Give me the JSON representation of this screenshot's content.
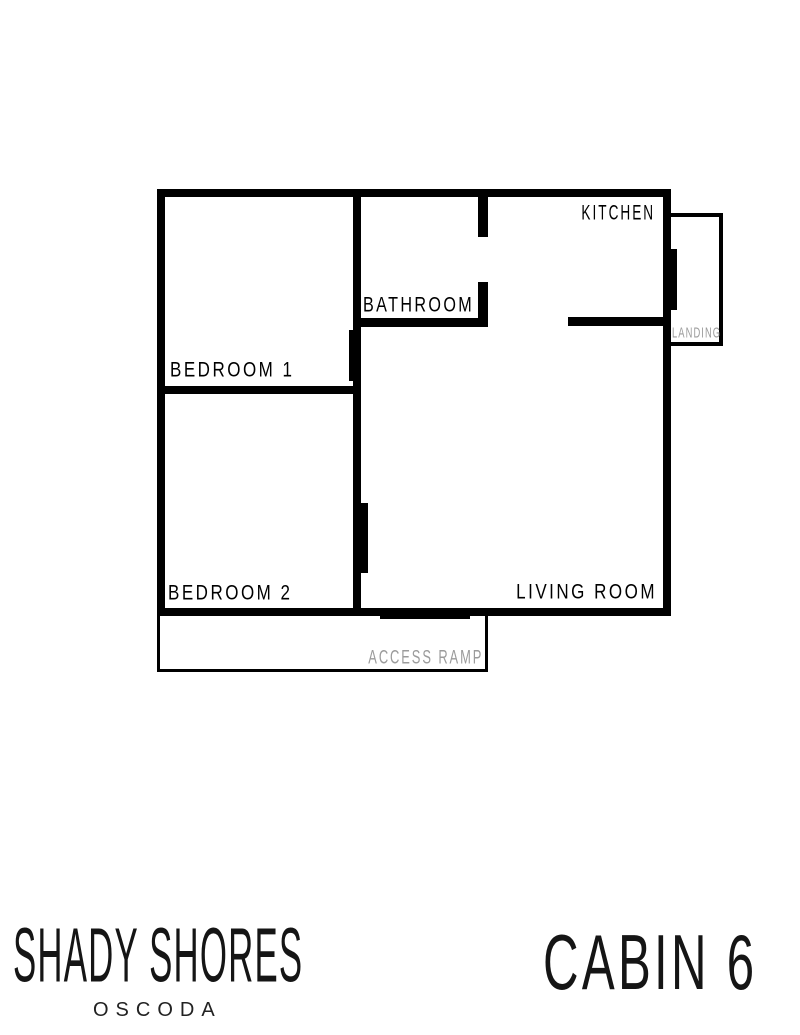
{
  "plan": {
    "rooms": {
      "bedroom1": "BEDROOM 1",
      "bedroom2": "BEDROOM 2",
      "bathroom": "BATHROOM",
      "kitchen": "KITCHEN",
      "living_room": "LIVING ROOM",
      "landing": "LANDING",
      "access_ramp": "ACCESS RAMP"
    },
    "colors": {
      "wall": "#000000",
      "room_label": "#000000",
      "muted_label": "#9b9b9b",
      "background": "#ffffff"
    }
  },
  "branding": {
    "resort_name": "SHADY SHORES",
    "location": "OSCODA",
    "unit_label": "CABIN 6"
  }
}
